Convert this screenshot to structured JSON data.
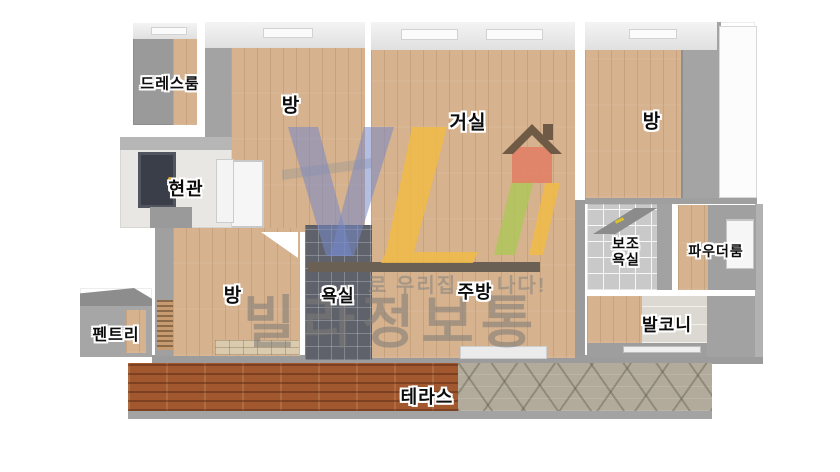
{
  "rooms": {
    "dressroom": "드레스룸",
    "room_top_left": "방",
    "living_room": "거실",
    "room_top_right": "방",
    "entrance": "현관",
    "room_bottom_left": "방",
    "bathroom": "욕실",
    "kitchen": "주방",
    "sub_bathroom_line1": "보조",
    "sub_bathroom_line2": "욕실",
    "powder_room": "파우더룸",
    "balcony": "발코니",
    "pantry": "펜트리",
    "terrace": "테라스"
  },
  "watermark": {
    "brand_text": "빌라정보통",
    "slogan_fragment_left": "로 우리집",
    "slogan_fragment_right": "나다!"
  },
  "colors": {
    "wood": "#d6b28e",
    "wall": "#a8a8a8",
    "dark_tile": "#5f626a",
    "light_tile": "#c9c9c9",
    "brick": "#a2582e",
    "stone": "#b2ab9b",
    "door": "#3a3e49",
    "logo_blue": "rgba(118,136,199,0.55)",
    "logo_yellow": "rgba(240,187,70,0.85)",
    "logo_green": "rgba(176,198,90,0.85)",
    "logo_house_body": "rgba(226,128,102,0.9)",
    "logo_house_roof": "#6f5b45",
    "wm_text": "rgba(125,122,118,0.55)"
  }
}
